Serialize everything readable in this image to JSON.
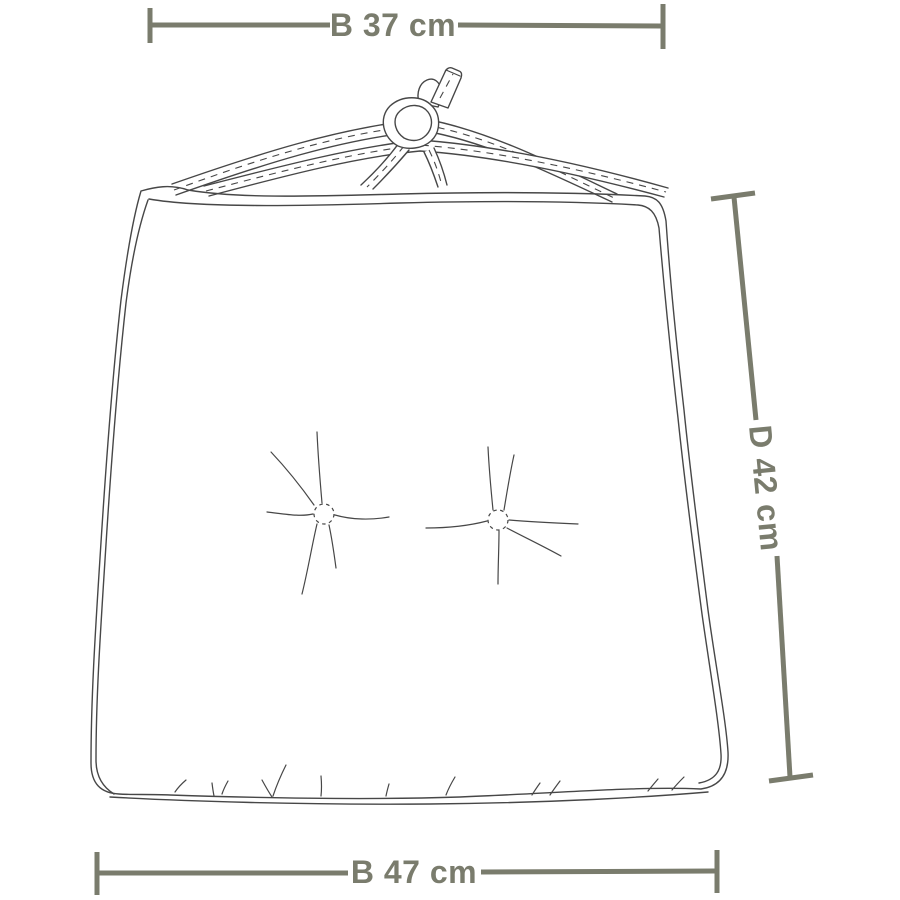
{
  "figure": {
    "description": "Line-drawing dimension diagram of a tie-on seat cushion with two tufted buttons",
    "dimensions": {
      "top_width": {
        "label": "B 37 cm",
        "value": 37,
        "unit": "cm",
        "position": "top"
      },
      "depth": {
        "label": "D 42 cm",
        "value": 42,
        "unit": "cm",
        "position": "right"
      },
      "bottom_width": {
        "label": "B 47 cm",
        "value": 47,
        "unit": "cm",
        "position": "bottom"
      }
    },
    "colors": {
      "dimension": "#7a7c6d",
      "outline": "#474747",
      "background": "#ffffff"
    }
  }
}
